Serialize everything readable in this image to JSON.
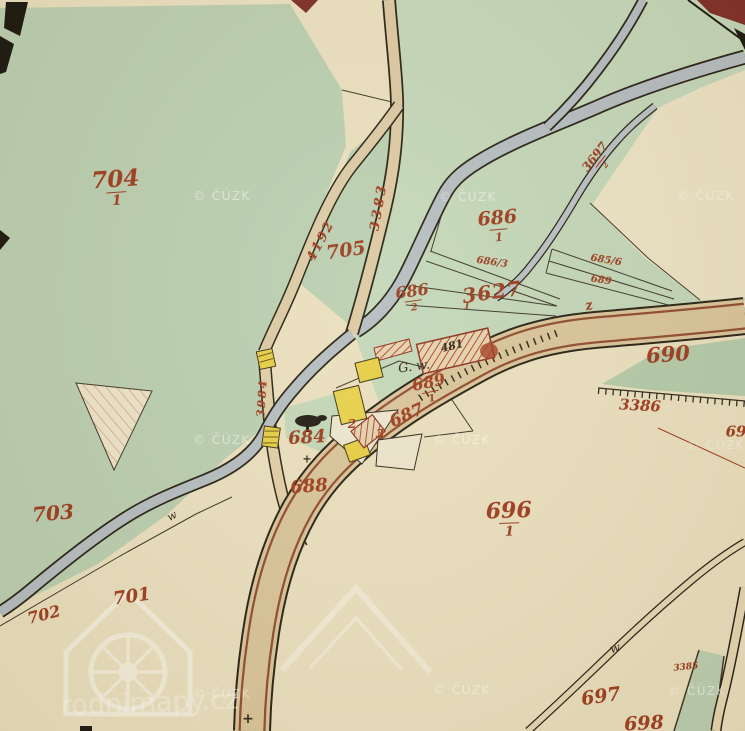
{
  "map": {
    "description": "Historical cadastral map sheet (stable cadastre style) with green meadows, cream fields, roads, a stream, and yellow/red buildings",
    "colors": {
      "label_red": "#9c3a1d",
      "ink": "#2c2518",
      "white": "#ffffff",
      "paper": "#eae0c0",
      "green1": "#bacfb2",
      "green2": "#c3d7ba",
      "green3": "#b3cbac",
      "road_tan": "#d9c59c",
      "road_red_stripe": "#8f4a2e",
      "stream_gray": "#b4bdc2",
      "building_yellow": "#e6ce44",
      "building_red_hatch": "#b5452c",
      "maroon": "#7c2b25"
    },
    "watermark_copyright": "© ČÚZK",
    "watermark_logo_text": "rodnimapy.cz",
    "labels": [
      {
        "name": "parcel-704",
        "text": "704",
        "frac": "1",
        "x": 116,
        "y": 188,
        "size": 23,
        "rot": -4
      },
      {
        "name": "parcel-705",
        "text": "705",
        "x": 346,
        "y": 251,
        "size": 19,
        "rot": -8
      },
      {
        "name": "road-3383",
        "text": "3383",
        "x": 379,
        "y": 207,
        "size": 13,
        "rot": -80,
        "ls": 3
      },
      {
        "name": "road-4192",
        "text": "4192",
        "x": 321,
        "y": 241,
        "size": 13,
        "rot": -62,
        "ls": 2
      },
      {
        "name": "parcel-686-1",
        "text": "686",
        "frac": "1",
        "x": 498,
        "y": 226,
        "size": 19,
        "rot": -5
      },
      {
        "name": "parcel-686-2",
        "text": "686",
        "frac": "2",
        "x": 413,
        "y": 298,
        "size": 16,
        "rot": -8
      },
      {
        "name": "parcel-686-3",
        "text": "686/3",
        "x": 492,
        "y": 263,
        "size": 10,
        "rot": 8
      },
      {
        "name": "road-3627",
        "text": "3627",
        "x": 492,
        "y": 292,
        "size": 20,
        "rot": -8,
        "ls": 1
      },
      {
        "name": "label-1",
        "text": "1",
        "x": 467,
        "y": 307,
        "size": 9,
        "rot": 0
      },
      {
        "name": "parcel-685-6",
        "text": "685/6",
        "x": 606,
        "y": 261,
        "size": 10,
        "rot": 9
      },
      {
        "name": "parcel-689-strip",
        "text": "689",
        "x": 601,
        "y": 281,
        "size": 10,
        "rot": 9
      },
      {
        "name": "parcel-690",
        "text": "690",
        "x": 668,
        "y": 354,
        "size": 21,
        "rot": -4
      },
      {
        "name": "road-3386",
        "text": "3386",
        "x": 640,
        "y": 406,
        "size": 15,
        "rot": 3
      },
      {
        "name": "parcel-69x",
        "text": "69",
        "x": 736,
        "y": 432,
        "size": 15,
        "rot": 0
      },
      {
        "name": "road-3697-2",
        "text": "3697",
        "frac": "2",
        "x": 599,
        "y": 160,
        "size": 12,
        "rot": -52
      },
      {
        "name": "house-481",
        "text": "481",
        "x": 452,
        "y": 346,
        "size": 11,
        "rot": -14,
        "color": "ink"
      },
      {
        "name": "note-gw",
        "text": "G. w.",
        "x": 414,
        "y": 367,
        "size": 13,
        "rot": -8,
        "color": "ink",
        "cls": "script"
      },
      {
        "name": "parcel-689-1",
        "text": "689",
        "frac": "1",
        "x": 430,
        "y": 389,
        "size": 16,
        "rot": -12
      },
      {
        "name": "parcel-687",
        "text": "687",
        "x": 407,
        "y": 416,
        "size": 17,
        "rot": -24
      },
      {
        "name": "label-2",
        "text": "2",
        "x": 352,
        "y": 424,
        "size": 12
      },
      {
        "name": "label-3",
        "text": "3",
        "x": 380,
        "y": 434,
        "size": 12
      },
      {
        "name": "parcel-684",
        "text": "684",
        "x": 307,
        "y": 438,
        "size": 18,
        "rot": -3
      },
      {
        "name": "mark-plus-684",
        "text": "+",
        "x": 307,
        "y": 459,
        "size": 11,
        "color": "ink"
      },
      {
        "name": "parcel-688",
        "text": "688",
        "x": 309,
        "y": 487,
        "size": 18,
        "rot": -4
      },
      {
        "name": "road-3984",
        "text": "3984",
        "x": 262,
        "y": 398,
        "size": 11,
        "rot": -86,
        "ls": 2
      },
      {
        "name": "parcel-696",
        "text": "696",
        "frac": "1",
        "x": 509,
        "y": 519,
        "size": 22,
        "rot": -2
      },
      {
        "name": "parcel-703",
        "text": "703",
        "x": 53,
        "y": 513,
        "size": 20,
        "rot": -5
      },
      {
        "name": "parcel-702",
        "text": "702",
        "x": 44,
        "y": 615,
        "size": 16,
        "rot": -14
      },
      {
        "name": "parcel-701",
        "text": "701",
        "x": 132,
        "y": 597,
        "size": 18,
        "rot": -8
      },
      {
        "name": "parcel-697",
        "text": "697",
        "x": 601,
        "y": 697,
        "size": 19,
        "rot": -8
      },
      {
        "name": "parcel-698",
        "text": "698",
        "x": 644,
        "y": 724,
        "size": 19,
        "rot": -3
      },
      {
        "name": "road-3385",
        "text": "3385",
        "x": 686,
        "y": 668,
        "size": 9,
        "rot": -6
      },
      {
        "name": "mark-culvert",
        "text": "z",
        "x": 589,
        "y": 306,
        "size": 13,
        "rot": -15
      },
      {
        "name": "mark-path-w1",
        "text": "w",
        "x": 615,
        "y": 648,
        "size": 12,
        "rot": -15,
        "color": "ink",
        "cls": "script"
      },
      {
        "name": "mark-path-w2",
        "text": "w",
        "x": 172,
        "y": 516,
        "size": 11,
        "rot": -28,
        "color": "ink",
        "cls": "script"
      },
      {
        "name": "mark-plus-bottom",
        "text": "+",
        "x": 248,
        "y": 719,
        "size": 14,
        "color": "ink"
      },
      {
        "name": "watermark-cuzk",
        "text": "© ČÚZK",
        "x": 222,
        "y": 196,
        "size": 12,
        "cls": "wm",
        "color": "white",
        "opacity": 0.5,
        "ls": 1.5
      },
      {
        "name": "watermark-cuzk",
        "text": "© ČÚZK",
        "x": 468,
        "y": 197,
        "size": 12,
        "cls": "wm",
        "color": "white",
        "opacity": 0.45,
        "ls": 1.5
      },
      {
        "name": "watermark-cuzk",
        "text": "© ČÚZK",
        "x": 706,
        "y": 196,
        "size": 12,
        "cls": "wm",
        "color": "white",
        "opacity": 0.45,
        "ls": 1.5
      },
      {
        "name": "watermark-cuzk",
        "text": "© ČÚZK",
        "x": 222,
        "y": 440,
        "size": 12,
        "cls": "wm",
        "color": "white",
        "opacity": 0.5,
        "ls": 1.5
      },
      {
        "name": "watermark-cuzk",
        "text": "© ČÚZK",
        "x": 462,
        "y": 440,
        "size": 12,
        "cls": "wm",
        "color": "white",
        "opacity": 0.5,
        "ls": 1.5
      },
      {
        "name": "watermark-cuzk",
        "text": "© ČÚZK",
        "x": 716,
        "y": 445,
        "size": 12,
        "cls": "wm",
        "color": "white",
        "opacity": 0.4,
        "ls": 1.5
      },
      {
        "name": "watermark-cuzk",
        "text": "© ČÚZK",
        "x": 222,
        "y": 694,
        "size": 12,
        "cls": "wm",
        "color": "white",
        "opacity": 0.5,
        "ls": 1.5
      },
      {
        "name": "watermark-cuzk",
        "text": "© ČÚZK",
        "x": 462,
        "y": 690,
        "size": 12,
        "cls": "wm",
        "color": "white",
        "opacity": 0.5,
        "ls": 1.5
      },
      {
        "name": "watermark-cuzk",
        "text": "© ČÚZK",
        "x": 697,
        "y": 691,
        "size": 12,
        "cls": "wm",
        "color": "white",
        "opacity": 0.55,
        "ls": 1.5
      },
      {
        "name": "watermark-logo-text",
        "text": "rodnimapy.cz",
        "x": 150,
        "y": 703,
        "size": 27,
        "cls": "wm script",
        "color": "white",
        "opacity": 0.38,
        "rot": -2
      }
    ]
  }
}
